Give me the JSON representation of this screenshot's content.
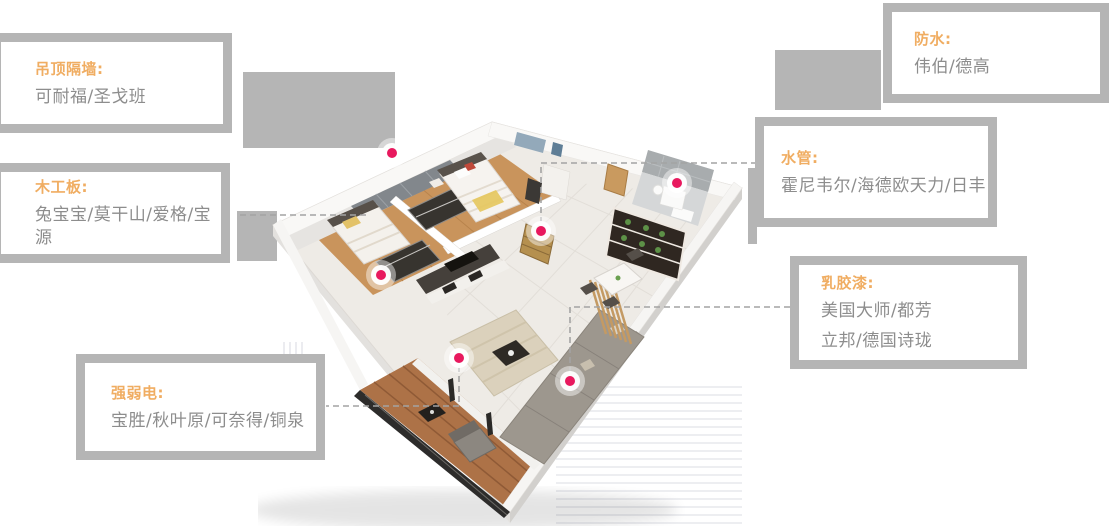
{
  "page": {
    "background": "#ffffff",
    "description_type": "renovation-materials-floorplan-infographic"
  },
  "colors": {
    "accent_orange": "#f0ad62",
    "body_text": "#8d8d8d",
    "box_border": "#b5b5b5",
    "pin_pink": "#e8195e",
    "dashed_line": "#a3a3a3"
  },
  "callouts": [
    {
      "id": "ceiling-partition",
      "label": "吊顶隔墙:",
      "lines": [
        "可耐福/圣戈班"
      ]
    },
    {
      "id": "wood-board",
      "label": "木工板:",
      "lines": [
        "兔宝宝/莫干山/爱格/宝源"
      ]
    },
    {
      "id": "electric",
      "label": "强弱电:",
      "lines": [
        "宝胜/秋叶原/可奈得/铜泉"
      ]
    },
    {
      "id": "waterproof",
      "label": "防水:",
      "lines": [
        "伟伯/德高"
      ]
    },
    {
      "id": "water-pipe",
      "label": "水管:",
      "lines": [
        "霍尼韦尔/海德欧天力/日丰"
      ]
    },
    {
      "id": "latex-paint",
      "label": "乳胶漆:",
      "lines": [
        "美国大师/都芳",
        "立邦/德国诗珑"
      ]
    }
  ],
  "pins": [
    {
      "id": "pin-1"
    },
    {
      "id": "pin-2"
    },
    {
      "id": "pin-3"
    },
    {
      "id": "pin-4"
    },
    {
      "id": "pin-5"
    },
    {
      "id": "pin-6"
    }
  ]
}
